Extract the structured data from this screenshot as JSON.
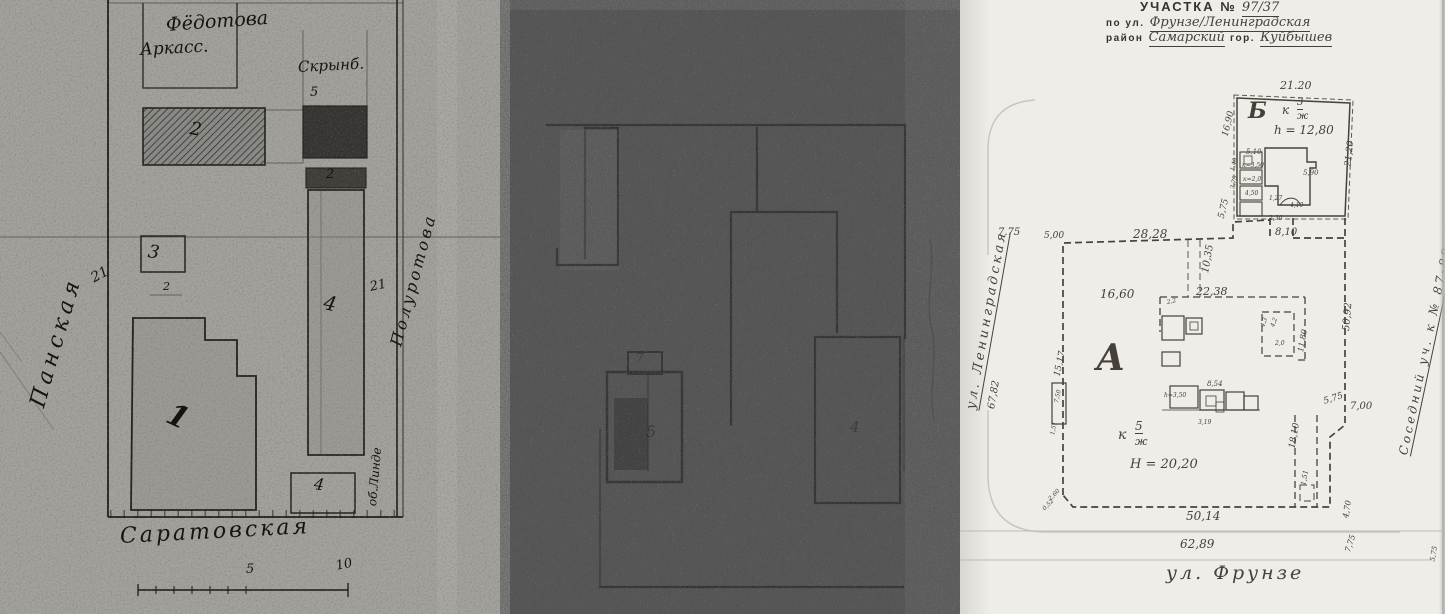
{
  "colors": {
    "ink_left": "#15140f",
    "ink_right": "#45413a",
    "paper_right": "#eeede8",
    "scan_left": "#a4a29d",
    "scan_middle": "#585858"
  },
  "right_panel": {
    "header": {
      "title_typed": "УЧАСТКА №",
      "plot_number": "97/37",
      "street_prefix": "по ул.",
      "street_names": "Фрунзе/Ленинградская",
      "district_prefix": "район",
      "district": "Самарский",
      "city_prefix": "гор.",
      "city": "Куйбышев"
    },
    "labels": [
      {
        "t": "21.20",
        "x": 320,
        "y": 80,
        "s": 11,
        "c": "hand",
        "n": "dim-top-b"
      },
      {
        "t": "Б",
        "x": 288,
        "y": 100,
        "s": 22,
        "c": "hand b",
        "n": "building-letter-b"
      },
      {
        "t": "к",
        "x": 322,
        "y": 104,
        "s": 12,
        "c": "hand"
      },
      {
        "t": "3",
        "x": 337,
        "y": 98,
        "s": 10,
        "c": "hand u"
      },
      {
        "t": "ж",
        "x": 337,
        "y": 112,
        "s": 10,
        "c": "hand"
      },
      {
        "t": "h = 12,80",
        "x": 314,
        "y": 124,
        "s": 12,
        "c": "hand",
        "n": "building-b-height"
      },
      {
        "t": "16,90",
        "x": 266,
        "y": 132,
        "s": 9,
        "r": -76,
        "c": "hand"
      },
      {
        "t": "21,20",
        "x": 389,
        "y": 162,
        "s": 9,
        "r": -84,
        "c": "hand"
      },
      {
        "t": "5,10",
        "x": 286,
        "y": 149,
        "s": 7,
        "c": "hand"
      },
      {
        "t": "к=3,50",
        "x": 282,
        "y": 163,
        "s": 6,
        "c": "hand"
      },
      {
        "t": "к=2,0",
        "x": 283,
        "y": 177,
        "s": 6,
        "c": "hand"
      },
      {
        "t": "4,50",
        "x": 285,
        "y": 191,
        "s": 6,
        "c": "hand"
      },
      {
        "t": "1,40",
        "x": 273,
        "y": 168,
        "s": 6,
        "r": -76,
        "c": "hand"
      },
      {
        "t": "3,75",
        "x": 273,
        "y": 186,
        "s": 6,
        "r": -76,
        "c": "hand"
      },
      {
        "t": "5,90",
        "x": 343,
        "y": 170,
        "s": 7,
        "c": "hand"
      },
      {
        "t": "1,27",
        "x": 309,
        "y": 196,
        "s": 6,
        "c": "hand"
      },
      {
        "t": "4,10",
        "x": 330,
        "y": 203,
        "s": 6,
        "c": "hand"
      },
      {
        "t": "2,30",
        "x": 309,
        "y": 216,
        "s": 6,
        "c": "hand"
      },
      {
        "t": "8,10",
        "x": 315,
        "y": 228,
        "s": 10,
        "c": "hand"
      },
      {
        "t": "5,75",
        "x": 262,
        "y": 214,
        "s": 9,
        "r": -76,
        "c": "hand"
      },
      {
        "t": "7.75",
        "x": 38,
        "y": 228,
        "s": 10,
        "c": "hand"
      },
      {
        "t": "5,00",
        "x": 84,
        "y": 232,
        "s": 9,
        "c": "hand"
      },
      {
        "t": "28,28",
        "x": 173,
        "y": 228,
        "s": 12,
        "c": "hand"
      },
      {
        "t": "10,35",
        "x": 246,
        "y": 268,
        "s": 10,
        "r": -80,
        "c": "hand"
      },
      {
        "t": "22,38",
        "x": 236,
        "y": 286,
        "s": 11,
        "c": "hand"
      },
      {
        "t": "16,60",
        "x": 140,
        "y": 288,
        "s": 12,
        "c": "hand"
      },
      {
        "t": "А",
        "x": 136,
        "y": 340,
        "s": 36,
        "c": "hand b",
        "n": "plot-letter-a"
      },
      {
        "t": "15,17",
        "x": 98,
        "y": 372,
        "s": 9,
        "r": -78,
        "c": "hand"
      },
      {
        "t": "50,92",
        "x": 387,
        "y": 326,
        "s": 10,
        "r": -85,
        "c": "hand"
      },
      {
        "t": "11,80",
        "x": 341,
        "y": 348,
        "s": 8,
        "r": -80,
        "c": "hand"
      },
      {
        "t": "7,00",
        "x": 390,
        "y": 402,
        "s": 10,
        "c": "hand"
      },
      {
        "t": "5,75",
        "x": 364,
        "y": 398,
        "s": 9,
        "r": -18,
        "c": "hand"
      },
      {
        "t": "2,2",
        "x": 207,
        "y": 300,
        "s": 6,
        "r": -12,
        "c": "hand"
      },
      {
        "t": "8,54",
        "x": 247,
        "y": 381,
        "s": 7,
        "c": "hand"
      },
      {
        "t": "h=3,50",
        "x": 204,
        "y": 393,
        "s": 6,
        "c": "hand"
      },
      {
        "t": "4,3",
        "x": 303,
        "y": 324,
        "s": 6,
        "r": -70,
        "c": "hand"
      },
      {
        "t": "4,2",
        "x": 313,
        "y": 324,
        "s": 6,
        "r": -70,
        "c": "hand"
      },
      {
        "t": "2,0",
        "x": 315,
        "y": 341,
        "s": 6,
        "c": "hand"
      },
      {
        "t": "3,19",
        "x": 238,
        "y": 420,
        "s": 6,
        "c": "hand"
      },
      {
        "t": "7,50",
        "x": 97,
        "y": 400,
        "s": 6,
        "r": -78,
        "c": "hand"
      },
      {
        "t": "1,51",
        "x": 93,
        "y": 432,
        "s": 6,
        "r": -78,
        "c": "hand"
      },
      {
        "t": "к",
        "x": 158,
        "y": 428,
        "s": 14,
        "c": "hand"
      },
      {
        "t": "5",
        "x": 175,
        "y": 420,
        "s": 12,
        "c": "hand u"
      },
      {
        "t": "ж",
        "x": 175,
        "y": 436,
        "s": 11,
        "c": "hand"
      },
      {
        "t": "H = 20,20",
        "x": 170,
        "y": 458,
        "s": 13,
        "c": "hand",
        "n": "plot-a-height"
      },
      {
        "t": "18,10",
        "x": 333,
        "y": 444,
        "s": 9,
        "r": -80,
        "c": "hand"
      },
      {
        "t": "1,51",
        "x": 344,
        "y": 482,
        "s": 7,
        "r": -80,
        "c": "hand"
      },
      {
        "t": "50,14",
        "x": 226,
        "y": 510,
        "s": 12,
        "c": "hand"
      },
      {
        "t": "2,60",
        "x": 90,
        "y": 497,
        "s": 6,
        "r": -46,
        "c": "hand"
      },
      {
        "t": "0,52",
        "x": 84,
        "y": 507,
        "s": 6,
        "r": -46,
        "c": "hand"
      },
      {
        "t": "4,70",
        "x": 386,
        "y": 514,
        "s": 8,
        "r": -80,
        "c": "hand"
      },
      {
        "t": "7,75",
        "x": 388,
        "y": 548,
        "s": 8,
        "r": -72,
        "c": "hand"
      },
      {
        "t": "5,75",
        "x": 473,
        "y": 558,
        "s": 7,
        "r": -80,
        "c": "hand"
      },
      {
        "t": "ул. Ленинградская",
        "x": 12,
        "y": 402,
        "s": 13,
        "r": -80,
        "c": "hand u sp2",
        "n": "street-leningradskaya"
      },
      {
        "t": "67,82",
        "x": 32,
        "y": 404,
        "s": 10,
        "r": -80,
        "c": "hand"
      },
      {
        "t": "Соседний уч. к № 87-89",
        "x": 444,
        "y": 448,
        "s": 12,
        "r": -78,
        "c": "hand u sp2",
        "n": "neighbor-plot-label"
      },
      {
        "t": "62,89",
        "x": 220,
        "y": 538,
        "s": 12,
        "c": "hand",
        "n": "dim-street-frunze"
      },
      {
        "t": "ул. Фрунзе",
        "x": 206,
        "y": 564,
        "s": 19,
        "c": "hand sp2",
        "n": "street-frunze"
      }
    ]
  },
  "left_panel": {
    "labels": [
      {
        "t": "Фёдотова",
        "x": 166,
        "y": 16,
        "s": 19,
        "r": -4,
        "c": "ink",
        "n": "owner-name-top"
      },
      {
        "t": "Аркасс.",
        "x": 140,
        "y": 42,
        "s": 17,
        "r": -3,
        "c": "ink",
        "n": "owner-name-top-2"
      },
      {
        "t": "Скрынб.",
        "x": 298,
        "y": 60,
        "s": 15,
        "r": -3,
        "c": "ink",
        "n": "owner-name-right"
      },
      {
        "t": "5",
        "x": 310,
        "y": 86,
        "s": 13,
        "c": "ink"
      },
      {
        "t": "2",
        "x": 190,
        "y": 120,
        "s": 18,
        "r": 10,
        "c": "ink",
        "n": "building-number"
      },
      {
        "t": "2",
        "x": 326,
        "y": 168,
        "s": 13,
        "c": "ink",
        "n": "building-number"
      },
      {
        "t": "4",
        "x": 324,
        "y": 292,
        "s": 20,
        "r": 12,
        "c": "ink",
        "n": "building-number"
      },
      {
        "t": "21",
        "x": 92,
        "y": 272,
        "s": 14,
        "r": -28,
        "c": "ink",
        "n": "dim-21-left"
      },
      {
        "t": "21",
        "x": 370,
        "y": 281,
        "s": 13,
        "r": -12,
        "c": "ink",
        "n": "dim-21-right"
      },
      {
        "t": "3",
        "x": 148,
        "y": 243,
        "s": 18,
        "r": 8,
        "c": "ink",
        "n": "building-number"
      },
      {
        "t": "2",
        "x": 163,
        "y": 281,
        "s": 11,
        "c": "ink"
      },
      {
        "t": "1",
        "x": 168,
        "y": 398,
        "s": 30,
        "r": 25,
        "c": "ink b",
        "n": "building-number"
      },
      {
        "t": "4",
        "x": 314,
        "y": 476,
        "s": 16,
        "r": 8,
        "c": "ink",
        "n": "building-number"
      },
      {
        "t": "Панская",
        "x": 38,
        "y": 396,
        "s": 22,
        "r": -74,
        "c": "ink sp",
        "n": "street-left"
      },
      {
        "t": "Полуротова",
        "x": 396,
        "y": 338,
        "s": 16,
        "r": -75,
        "c": "ink sp2",
        "n": "side-note-right"
      },
      {
        "t": "об.Линде",
        "x": 372,
        "y": 500,
        "s": 12,
        "r": -85,
        "c": "ink",
        "n": "side-note-right-2"
      },
      {
        "t": "Саратовская",
        "x": 120,
        "y": 526,
        "s": 22,
        "r": -3,
        "c": "ink sp2",
        "n": "street-bottom"
      },
      {
        "t": "5",
        "x": 246,
        "y": 563,
        "s": 13,
        "c": "ink",
        "n": "scale-number"
      },
      {
        "t": "10",
        "x": 336,
        "y": 560,
        "s": 13,
        "r": -12,
        "c": "ink",
        "n": "scale-number"
      }
    ]
  },
  "middle_panel": {
    "labels": [
      {
        "t": "5",
        "x": 146,
        "y": 424,
        "s": 16,
        "c": "ghost",
        "n": "faint-building-number"
      },
      {
        "t": "4",
        "x": 350,
        "y": 420,
        "s": 15,
        "c": "ghost",
        "n": "faint-building-number"
      },
      {
        "t": "7",
        "x": 136,
        "y": 352,
        "s": 12,
        "c": "ghost",
        "n": "faint-mark"
      }
    ]
  }
}
